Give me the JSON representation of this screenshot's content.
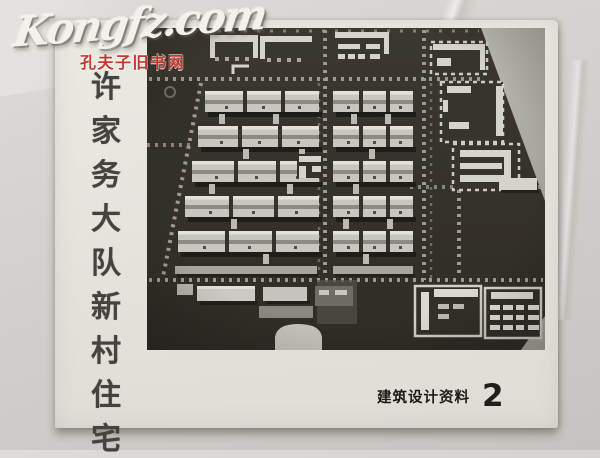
{
  "watermark": {
    "brand": "Kongfz.com",
    "caption": "孔夫子旧书网",
    "caption_color": "#c23a2e"
  },
  "cover": {
    "title": "许家务大队新村住宅",
    "title_chars": [
      "许",
      "家",
      "务",
      "大",
      "队",
      "新",
      "村",
      "住",
      "宅"
    ],
    "imprint_series": "建筑设计资料",
    "imprint_issue": "2",
    "photo_name": "new-village-housing-site-model-aerial-photo"
  }
}
